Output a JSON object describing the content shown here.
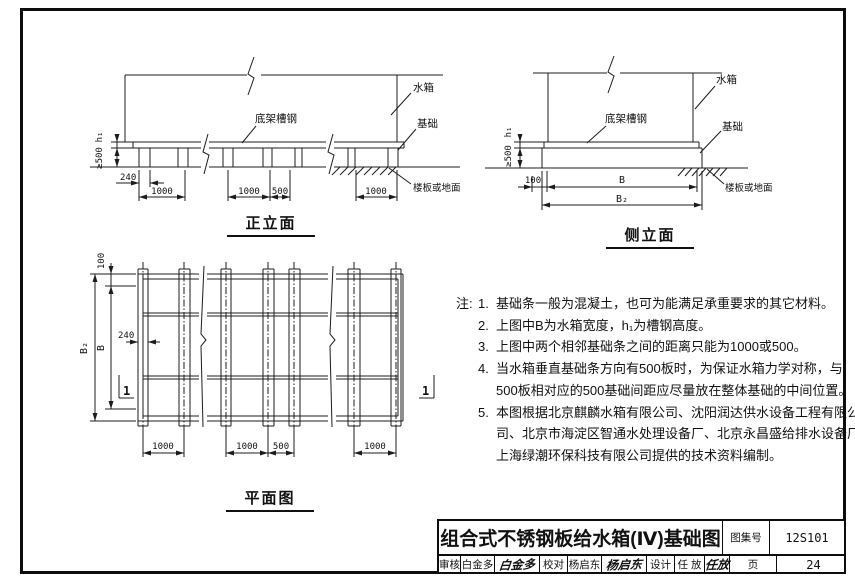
{
  "front_elevation": {
    "title": "正立面",
    "labels": {
      "tank": "水箱",
      "channel": "底架槽钢",
      "foundation": "基础",
      "floor": "楼板或地面"
    },
    "dims": {
      "strip_width": "240",
      "span1": "1000",
      "span2": "1000",
      "span3": "500",
      "span4": "1000",
      "found_height": "≥500",
      "channel_height": "h₁"
    }
  },
  "side_elevation": {
    "title": "侧立面",
    "labels": {
      "tank": "水箱",
      "channel": "底架槽钢",
      "foundation": "基础",
      "floor": "楼板或地面"
    },
    "dims": {
      "edge": "100",
      "width": "B",
      "total_width": "B₂",
      "found_height": "≥500",
      "channel_height": "h₁"
    }
  },
  "plan_view": {
    "title": "平面图",
    "dims": {
      "edge": "100",
      "width": "B",
      "total_width": "B₂",
      "strip_width": "240",
      "span1": "1000",
      "span2": "1000",
      "span3": "500",
      "span4": "1000"
    },
    "section_label": "1"
  },
  "notes": {
    "label": "注:",
    "items": [
      {
        "num": "1.",
        "lines": [
          "基础条一般为混凝土，也可为能满足承重要求的其它材料。"
        ]
      },
      {
        "num": "2.",
        "lines": [
          "上图中B为水箱宽度，h₁为槽钢高度。"
        ]
      },
      {
        "num": "3.",
        "lines": [
          "上图中两个相邻基础条之间的距离只能为1000或500。"
        ]
      },
      {
        "num": "4.",
        "lines": [
          "当水箱垂直基础条方向有500板时，为保证水箱力学对称，与",
          "500板相对应的500基础间距应尽量放在整体基础的中间位置。"
        ]
      },
      {
        "num": "5.",
        "lines": [
          "本图根据北京麒麟水箱有限公司、沈阳润达供水设备工程有限公",
          "司、北京市海淀区智通水处理设备厂、北京永昌盛给排水设备厂、",
          "上海绿潮环保科技有限公司提供的技术资料编制。"
        ]
      }
    ]
  },
  "title_block": {
    "drawing_title": "组合式不锈钢板给水箱(Ⅳ)基础图",
    "atlas_label": "图集号",
    "atlas_no": "12S101",
    "page_label": "页",
    "page_no": "24",
    "reviewer_label": "审核",
    "reviewer_name": "白金多",
    "reviewer_signature": "白金多",
    "checker_label": "校对",
    "checker_name": "杨启东",
    "checker_signature": "杨启东",
    "designer_label": "设计",
    "designer_name": "任 放",
    "designer_signature": "任放"
  }
}
